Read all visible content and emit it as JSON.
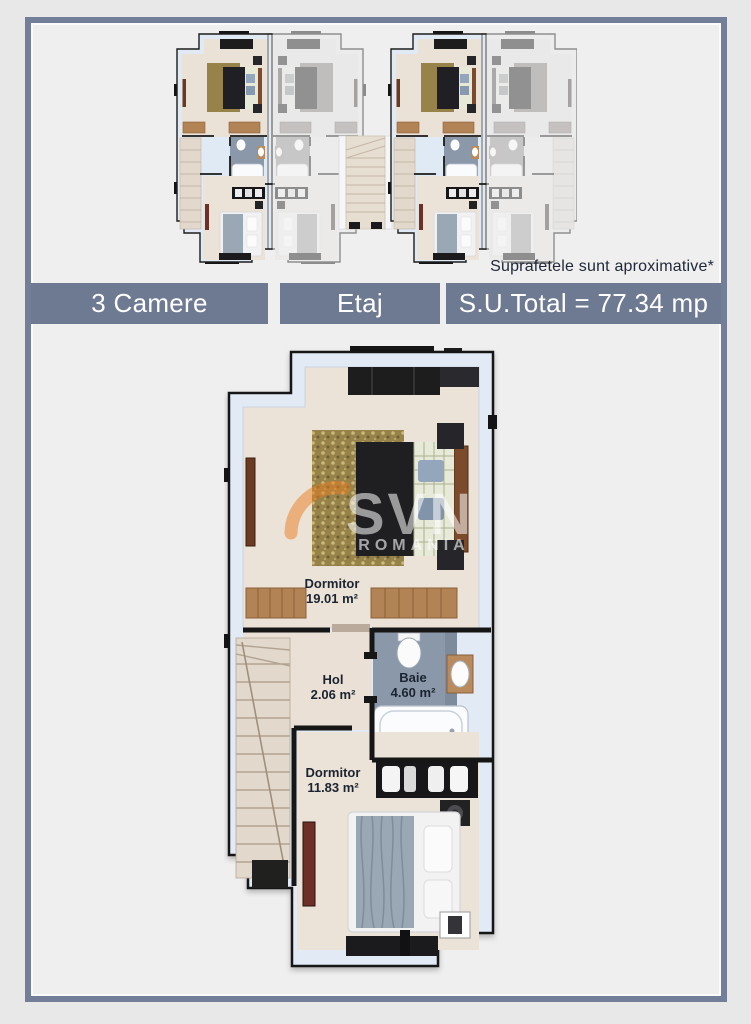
{
  "palette": {
    "outer_bg": "#e9e8e8",
    "inner_bg": "#f0efef",
    "frame_border": "#737e99",
    "bar_bg": "#6e7992",
    "accent_orange": "#e87b1e",
    "label_color": "#1b2430",
    "bar_text": "#ffffff"
  },
  "note": "Suprafetele sunt aproximative*",
  "bars": [
    {
      "label": "3 Camere"
    },
    {
      "label": "Etaj"
    },
    {
      "label": "S.U.Total = 77.34 mp"
    }
  ],
  "watermark": {
    "line1": "SVN",
    "line2": "ROMANIA"
  },
  "plan": {
    "rooms": [
      {
        "name": "Dormitor",
        "area": "19.01 m²"
      },
      {
        "name": "Hol",
        "area": "2.06 m²"
      },
      {
        "name": "Baie",
        "area": "4.60 m²"
      },
      {
        "name": "Dormitor",
        "area": "11.83 m²"
      }
    ]
  }
}
